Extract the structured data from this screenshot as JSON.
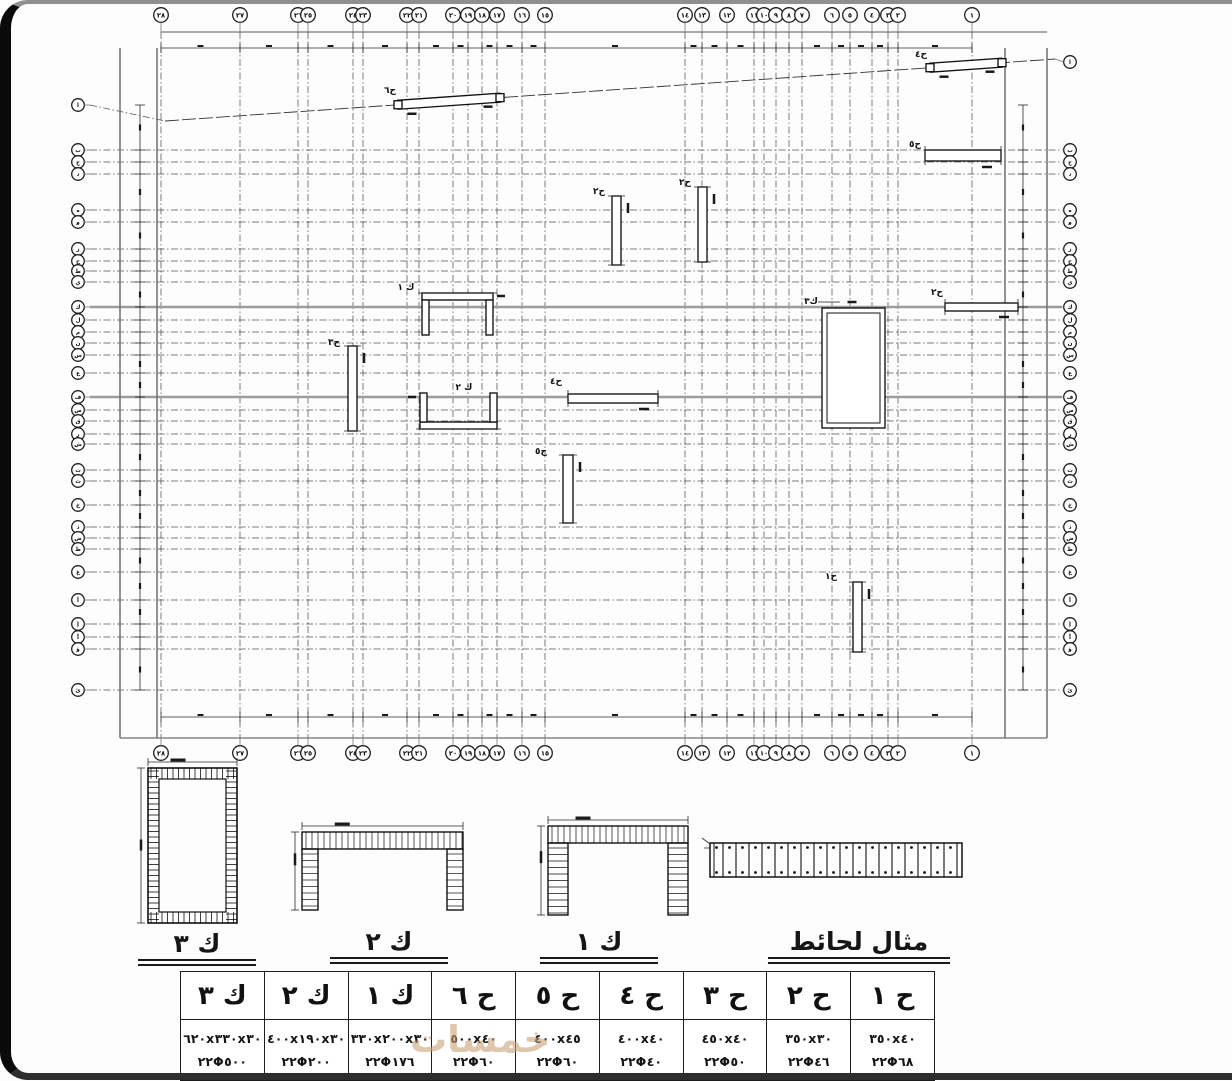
{
  "watermark": "خمسات",
  "details": {
    "labels": [
      "ك ٣",
      "ك ٢",
      "ك ١",
      "مثال لحائط"
    ]
  },
  "table": {
    "columns": [
      {
        "header": "ك ٣",
        "size": "٦٢٠x٣٣٠x٣٠",
        "rebar": "٢٢Φ٥٠٠"
      },
      {
        "header": "ك ٢",
        "size": "٤٠٠x١٩٠x٣٠",
        "rebar": "٢٢Φ٢٠٠"
      },
      {
        "header": "ك ١",
        "size": "٣٣٠x٢٠٠x٣٠",
        "rebar": "٢٢Φ١٧٦"
      },
      {
        "header": "ح ٦",
        "size": "٥٠٠x٤٠",
        "rebar": "٢٢Φ٦٠"
      },
      {
        "header": "ح ٥",
        "size": "٤٠٠x٤٥",
        "rebar": "٢٢Φ٦٠"
      },
      {
        "header": "ح ٤",
        "size": "٤٠٠x٤٠",
        "rebar": "٢٢Φ٤٠"
      },
      {
        "header": "ح ٣",
        "size": "٤٥٠x٤٠",
        "rebar": "٢٢Φ٥٠"
      },
      {
        "header": "ح ٢",
        "size": "٣٥٠x٣٠",
        "rebar": "٢٢Φ٤٦"
      },
      {
        "header": "ح ١",
        "size": "٣٥٠x٤٠",
        "rebar": "٢٢Φ٦٨"
      }
    ]
  },
  "plan": {
    "cols": [
      {
        "label": "٢٨",
        "x": 161
      },
      {
        "label": "٢٧",
        "x": 240
      },
      {
        "label": "٢٦",
        "x": 298
      },
      {
        "label": "٢٥",
        "x": 308
      },
      {
        "label": "٢٤",
        "x": 353
      },
      {
        "label": "٢٣",
        "x": 363
      },
      {
        "label": "٢٢",
        "x": 407
      },
      {
        "label": "٢١",
        "x": 419
      },
      {
        "label": "٢٠",
        "x": 453
      },
      {
        "label": "١٩",
        "x": 468
      },
      {
        "label": "١٨",
        "x": 482
      },
      {
        "label": "١٧",
        "x": 497
      },
      {
        "label": "١٦",
        "x": 522
      },
      {
        "label": "١٥",
        "x": 545
      },
      {
        "label": "١٤",
        "x": 685
      },
      {
        "label": "١٣",
        "x": 702
      },
      {
        "label": "١٢",
        "x": 727
      },
      {
        "label": "١١",
        "x": 754
      },
      {
        "label": "١٠",
        "x": 764
      },
      {
        "label": "٩",
        "x": 776
      },
      {
        "label": "٨",
        "x": 789
      },
      {
        "label": "٧",
        "x": 802
      },
      {
        "label": "٦",
        "x": 832
      },
      {
        "label": "٥",
        "x": 850
      },
      {
        "label": "٤",
        "x": 872
      },
      {
        "label": "٣",
        "x": 888
      },
      {
        "label": "٢",
        "x": 898
      },
      {
        "label": "١",
        "x": 972
      }
    ],
    "rows": [
      {
        "label": "ا",
        "y": 105,
        "slant": true
      },
      {
        "label": "ب",
        "y": 150
      },
      {
        "label": "ج",
        "y": 162
      },
      {
        "label": "د",
        "y": 174
      },
      {
        "label": "ه",
        "y": 210
      },
      {
        "label": "و",
        "y": 222
      },
      {
        "label": "ز",
        "y": 249
      },
      {
        "label": "ح",
        "y": 261
      },
      {
        "label": "ط",
        "y": 271
      },
      {
        "label": "ي",
        "y": 282
      },
      {
        "label": "ك",
        "y": 307,
        "strong": true
      },
      {
        "label": "ل",
        "y": 320
      },
      {
        "label": "م",
        "y": 332
      },
      {
        "label": "ن",
        "y": 343
      },
      {
        "label": "س",
        "y": 355
      },
      {
        "label": "ع",
        "y": 373
      },
      {
        "label": "ف",
        "y": 397,
        "strong": true
      },
      {
        "label": "ص",
        "y": 410
      },
      {
        "label": "ق",
        "y": 421
      },
      {
        "label": "ر",
        "y": 434
      },
      {
        "label": "ش",
        "y": 444
      },
      {
        "label": "ت",
        "y": 470
      },
      {
        "label": "ث",
        "y": 481
      },
      {
        "label": "خ",
        "y": 505
      },
      {
        "label": "ذ",
        "y": 527
      },
      {
        "label": "ض",
        "y": 538
      },
      {
        "label": "ظ",
        "y": 549
      },
      {
        "label": "غ",
        "y": 572
      },
      {
        "label": "أ",
        "y": 600
      },
      {
        "label": "إ",
        "y": 624
      },
      {
        "label": "آ",
        "y": 637
      },
      {
        "label": "ؤ",
        "y": 649
      },
      {
        "label": "ئ",
        "y": 690
      }
    ],
    "diag": {
      "x1": 165,
      "y1": 121,
      "x2": 1055,
      "y2": 59,
      "right_y": 62
    },
    "walls": [
      {
        "label": "ح٦",
        "type": "slant",
        "x1": 398,
        "x2": 500,
        "t": 9,
        "lx": 390,
        "ly": 93
      },
      {
        "label": "ح٤",
        "type": "slant",
        "x1": 930,
        "x2": 1002,
        "t": 9,
        "lx": 921,
        "ly": 57
      },
      {
        "label": "ح٥",
        "type": "rect",
        "x": 925,
        "y": 150,
        "w": 76,
        "h": 11,
        "lx": 915,
        "ly": 147
      },
      {
        "label": "ح٢",
        "type": "rect",
        "x": 612,
        "y": 196,
        "w": 9,
        "h": 69,
        "lx": 599,
        "ly": 194
      },
      {
        "label": "ح٢",
        "type": "rect",
        "x": 698,
        "y": 187,
        "w": 9,
        "h": 75,
        "lx": 685,
        "ly": 185
      },
      {
        "label": "ح٣",
        "type": "rect",
        "x": 348,
        "y": 346,
        "w": 9,
        "h": 85,
        "lx": 334,
        "ly": 345
      },
      {
        "label": "ح٤",
        "type": "rect",
        "x": 568,
        "y": 394,
        "w": 90,
        "h": 9,
        "lx": 556,
        "ly": 384
      },
      {
        "label": "ح٥",
        "type": "rect",
        "x": 563,
        "y": 455,
        "w": 10,
        "h": 68,
        "lx": 541,
        "ly": 454
      },
      {
        "label": "ح١",
        "type": "rect",
        "x": 853,
        "y": 582,
        "w": 9,
        "h": 70,
        "lx": 831,
        "ly": 579
      },
      {
        "label": "ح٢",
        "type": "rect",
        "x": 945,
        "y": 303,
        "w": 73,
        "h": 8,
        "lx": 937,
        "ly": 295
      },
      {
        "label": "ك ١",
        "type": "u",
        "x": 422,
        "y": 293,
        "w": 71,
        "h": 42,
        "t": 7,
        "open": "down",
        "lx": 406,
        "ly": 290
      },
      {
        "label": "ك ٢",
        "type": "u",
        "x": 420,
        "y": 393,
        "w": 77,
        "h": 36,
        "t": 7,
        "open": "up",
        "lx": 464,
        "ly": 390
      },
      {
        "label": "ك٣",
        "type": "box",
        "x": 822,
        "y": 308,
        "w": 63,
        "h": 120,
        "lx": 811,
        "ly": 304
      }
    ]
  }
}
